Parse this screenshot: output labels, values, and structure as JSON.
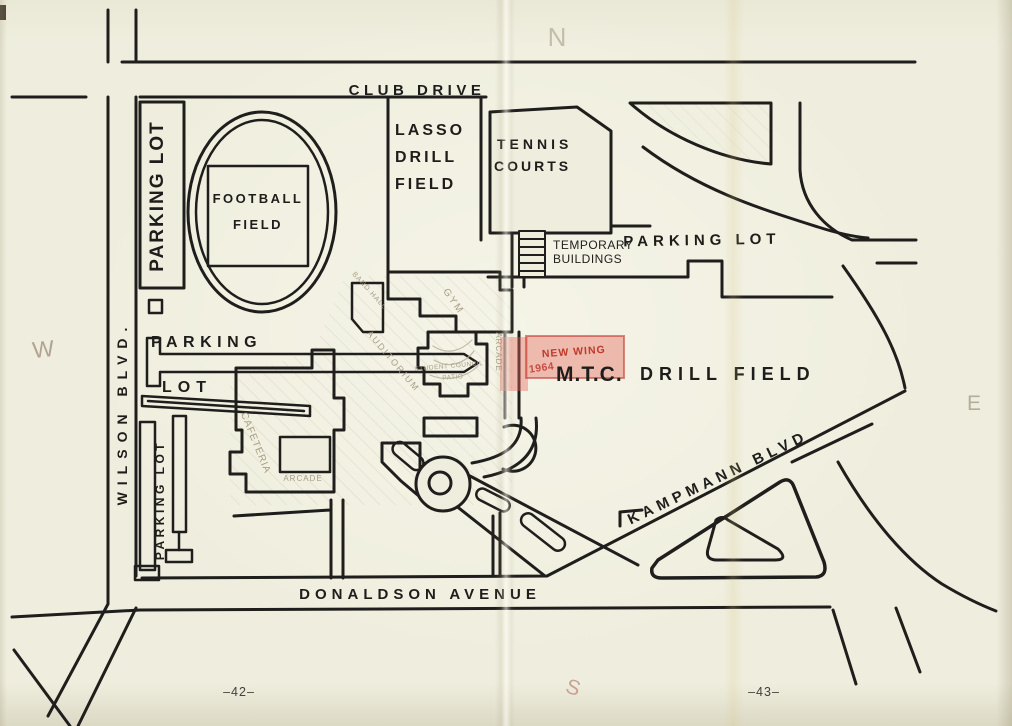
{
  "page": {
    "left_number": "–42–",
    "right_number": "–43–"
  },
  "compass": {
    "north": "N",
    "south": "S",
    "east": "E",
    "west": "W"
  },
  "streets": {
    "club_drive": "CLUB DRIVE",
    "wilson_blvd": "WILSON BLVD.",
    "donaldson_avenue": "DONALDSON AVENUE",
    "kampmann_blvd": "KAMPMANN BLVD"
  },
  "areas": {
    "parking_lot_west": "PARKING LOT",
    "football_field": [
      "FOOTBALL",
      "FIELD"
    ],
    "lasso_drill_field": [
      "LASSO",
      "DRILL",
      "FIELD"
    ],
    "tennis_courts": [
      "TENNIS",
      "COURTS"
    ],
    "temporary_buildings": [
      "TEMPORARY",
      "BUILDINGS"
    ],
    "parking_lot_northeast": "PARKING LOT",
    "parking_lot_center": [
      "PARKING",
      "LOT"
    ],
    "parking_lot_southwest": "PARKING LOT",
    "mtc_abbr": "M.T.C.",
    "drill_field": "DRILL FIELD"
  },
  "buildings": {
    "gym": "GYM",
    "arcade_upper": "ARCADE",
    "arcade_lower": "ARCADE",
    "cafeteria": "CAFETERIA",
    "auditorium": "AUDITORIUM",
    "band_hall": "BAND HALL",
    "student_council": [
      "STUDENT COUNCIL",
      "PATIO"
    ]
  },
  "annotations": {
    "new_wing_label": "NEW WING",
    "new_wing_year": "1964",
    "text_color": "#bf3a2e",
    "highlight_fill": "rgba(229,101,90,0.40)",
    "highlight_stroke": "rgba(196,62,52,0.60)"
  }
}
